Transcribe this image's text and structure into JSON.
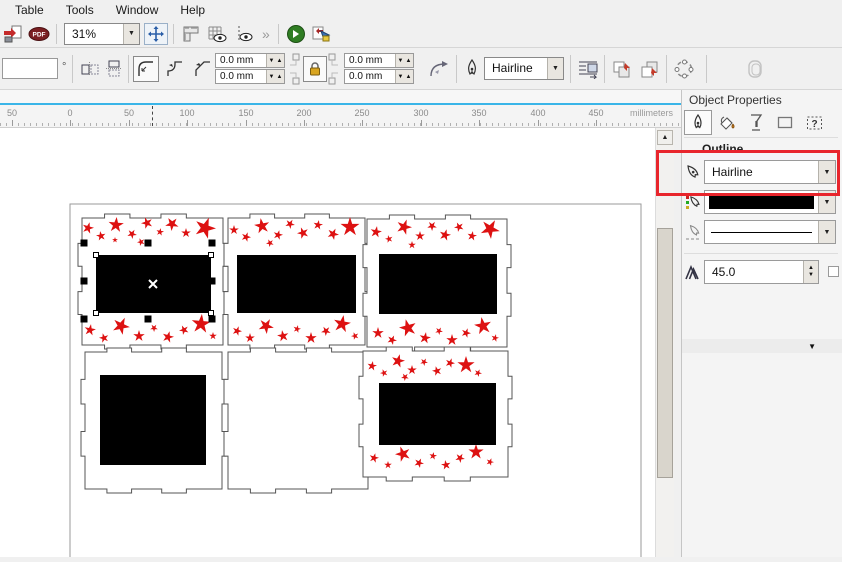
{
  "menu": {
    "items": [
      "Table",
      "Tools",
      "Window",
      "Help"
    ]
  },
  "toolbar": {
    "zoom_level": "31%",
    "overflow_chevron": "»",
    "pdf_label": "PDF"
  },
  "property_bar": {
    "rotation_angle": "",
    "degree_suffix": "°",
    "corner_radius_fields": [
      "0.0 mm",
      "0.0 mm",
      "0.0 mm",
      "0.0 mm"
    ],
    "outline_width": "Hairline"
  },
  "glyphs": {
    "down": "▼",
    "up": "▲",
    "question": "?",
    "cross": "×"
  },
  "ruler": {
    "labels": [
      {
        "t": "50",
        "x": 12
      },
      {
        "t": "0",
        "x": 70
      },
      {
        "t": "50",
        "x": 129
      },
      {
        "t": "100",
        "x": 187
      },
      {
        "t": "150",
        "x": 246
      },
      {
        "t": "200",
        "x": 304
      },
      {
        "t": "250",
        "x": 362
      },
      {
        "t": "300",
        "x": 421
      },
      {
        "t": "350",
        "x": 479
      },
      {
        "t": "400",
        "x": 538
      },
      {
        "t": "450",
        "x": 596
      }
    ],
    "unit": "millimeters"
  },
  "docker": {
    "title": "Object Properties",
    "section_title": "Outline",
    "outline_width": "Hairline",
    "outline_color": "#000000",
    "miter_limit": "45.0"
  },
  "colors": {
    "star_red": "#dd1111",
    "panel_stroke": "#555555",
    "shape_black": "#000000",
    "annotation_red": "#e8252c",
    "ruler_accent": "#3ab5e8"
  },
  "canvas": {
    "page": {
      "x": 70,
      "y": 76,
      "w": 571,
      "h": 353
    },
    "panels": [
      {
        "x": 82,
        "y": 90,
        "w": 141,
        "h": 127,
        "black": {
          "x": 96,
          "y": 127,
          "w": 115,
          "h": 58
        },
        "stars": [
          [
            88,
            100,
            6,
            15
          ],
          [
            101,
            108,
            5,
            -10
          ],
          [
            116,
            97,
            8,
            5
          ],
          [
            132,
            106,
            5,
            30
          ],
          [
            147,
            95,
            6,
            -20
          ],
          [
            160,
            104,
            4,
            10
          ],
          [
            172,
            96,
            7,
            40
          ],
          [
            186,
            105,
            5,
            0
          ],
          [
            205,
            100,
            11,
            20
          ],
          [
            141,
            114,
            4,
            50
          ],
          [
            115,
            112,
            3,
            0
          ],
          [
            90,
            202,
            6,
            10
          ],
          [
            104,
            210,
            5,
            -15
          ],
          [
            121,
            198,
            9,
            25
          ],
          [
            139,
            208,
            6,
            0
          ],
          [
            154,
            200,
            4,
            35
          ],
          [
            168,
            209,
            6,
            15
          ],
          [
            184,
            202,
            5,
            -25
          ],
          [
            201,
            196,
            10,
            5
          ],
          [
            213,
            208,
            4,
            0
          ]
        ]
      },
      {
        "x": 228,
        "y": 90,
        "w": 137,
        "h": 127,
        "black": {
          "x": 237,
          "y": 127,
          "w": 119,
          "h": 58
        },
        "stars": [
          [
            234,
            102,
            5,
            0
          ],
          [
            246,
            109,
            5,
            20
          ],
          [
            262,
            98,
            8,
            -10
          ],
          [
            278,
            107,
            5,
            15
          ],
          [
            290,
            96,
            5,
            30
          ],
          [
            303,
            105,
            6,
            -20
          ],
          [
            318,
            97,
            5,
            10
          ],
          [
            333,
            106,
            6,
            25
          ],
          [
            350,
            99,
            10,
            0
          ],
          [
            270,
            115,
            4,
            45
          ],
          [
            237,
            203,
            5,
            20
          ],
          [
            250,
            210,
            5,
            0
          ],
          [
            266,
            198,
            8,
            30
          ],
          [
            283,
            208,
            6,
            -10
          ],
          [
            297,
            201,
            4,
            15
          ],
          [
            311,
            210,
            6,
            0
          ],
          [
            326,
            203,
            5,
            40
          ],
          [
            342,
            196,
            9,
            10
          ],
          [
            355,
            208,
            4,
            -20
          ]
        ]
      },
      {
        "x": 367,
        "y": 91,
        "w": 140,
        "h": 128,
        "black": {
          "x": 379,
          "y": 126,
          "w": 118,
          "h": 60
        },
        "stars": [
          [
            376,
            104,
            6,
            10
          ],
          [
            389,
            111,
            4,
            -15
          ],
          [
            404,
            99,
            8,
            20
          ],
          [
            420,
            108,
            5,
            0
          ],
          [
            432,
            98,
            5,
            35
          ],
          [
            445,
            107,
            6,
            15
          ],
          [
            459,
            99,
            5,
            -25
          ],
          [
            472,
            108,
            5,
            10
          ],
          [
            490,
            101,
            10,
            30
          ],
          [
            412,
            117,
            4,
            0
          ],
          [
            378,
            205,
            6,
            0
          ],
          [
            392,
            212,
            5,
            25
          ],
          [
            408,
            200,
            9,
            -15
          ],
          [
            425,
            210,
            6,
            10
          ],
          [
            439,
            203,
            4,
            30
          ],
          [
            452,
            212,
            6,
            0
          ],
          [
            466,
            205,
            5,
            20
          ],
          [
            483,
            198,
            9,
            -10
          ],
          [
            495,
            210,
            4,
            15
          ]
        ]
      },
      {
        "x": 85,
        "y": 224,
        "w": 137,
        "h": 137,
        "black": {
          "x": 100,
          "y": 247,
          "w": 106,
          "h": 90
        },
        "stars": []
      },
      {
        "x": 228,
        "y": 224,
        "w": 140,
        "h": 137,
        "black": null,
        "stars": []
      },
      {
        "x": 363,
        "y": 223,
        "w": 145,
        "h": 126,
        "black": {
          "x": 379,
          "y": 255,
          "w": 117,
          "h": 62
        },
        "stars": [
          [
            372,
            238,
            5,
            10
          ],
          [
            384,
            245,
            4,
            -20
          ],
          [
            398,
            233,
            7,
            15
          ],
          [
            412,
            242,
            5,
            0
          ],
          [
            424,
            234,
            4,
            30
          ],
          [
            437,
            243,
            5,
            -15
          ],
          [
            450,
            235,
            5,
            20
          ],
          [
            466,
            237,
            9,
            0
          ],
          [
            478,
            245,
            4,
            25
          ],
          [
            405,
            249,
            4,
            40
          ],
          [
            374,
            330,
            5,
            15
          ],
          [
            388,
            337,
            4,
            0
          ],
          [
            403,
            326,
            8,
            -20
          ],
          [
            419,
            335,
            5,
            25
          ],
          [
            433,
            328,
            4,
            10
          ],
          [
            446,
            337,
            5,
            -10
          ],
          [
            460,
            330,
            5,
            30
          ],
          [
            476,
            324,
            8,
            0
          ],
          [
            490,
            334,
            4,
            20
          ]
        ]
      }
    ],
    "selection": {
      "handle_size": 7,
      "handles": [
        [
          84,
          115
        ],
        [
          148,
          115
        ],
        [
          212,
          115
        ],
        [
          84,
          153
        ],
        [
          212,
          153
        ],
        [
          84,
          191
        ],
        [
          148,
          191
        ],
        [
          212,
          191
        ]
      ],
      "nodes": [
        [
          96,
          127
        ],
        [
          211,
          127
        ],
        [
          96,
          185
        ],
        [
          211,
          185
        ]
      ],
      "center": [
        153,
        156
      ]
    }
  }
}
